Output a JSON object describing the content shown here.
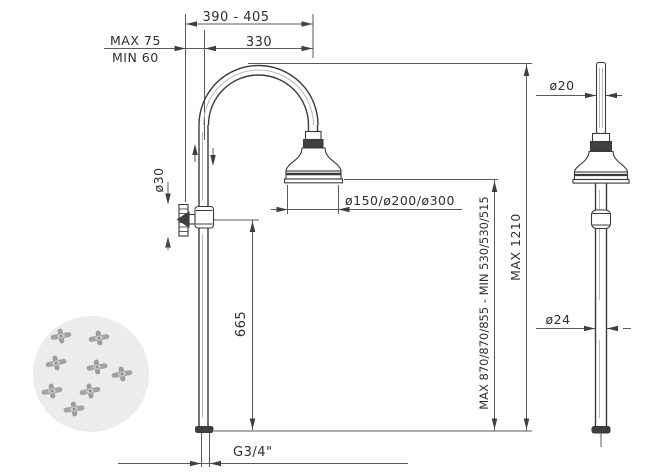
{
  "drawing": {
    "title": "shower-column-technical-drawing",
    "labels": {
      "span_390_405": "390 - 405",
      "max_75": "MAX 75",
      "min_60": "MIN 60",
      "span_330": "330",
      "dia_30": "ø30",
      "dia_150_200_300": "ø150/ø200/ø300",
      "height_665": "665",
      "max_min_heights": "MAX 870/870/855 - MIN 530/530/515",
      "max_1210": "MAX 1210",
      "thread": "G3/4\"",
      "dia_20": "ø20",
      "dia_24": "ø24"
    },
    "colors": {
      "line": "#4a4a4a",
      "outline": "#3a3a3a",
      "text": "#2e2e2e",
      "background": "#ffffff",
      "watermark_circle": "#ececec",
      "watermark_motif": "#a3a3a3"
    }
  }
}
